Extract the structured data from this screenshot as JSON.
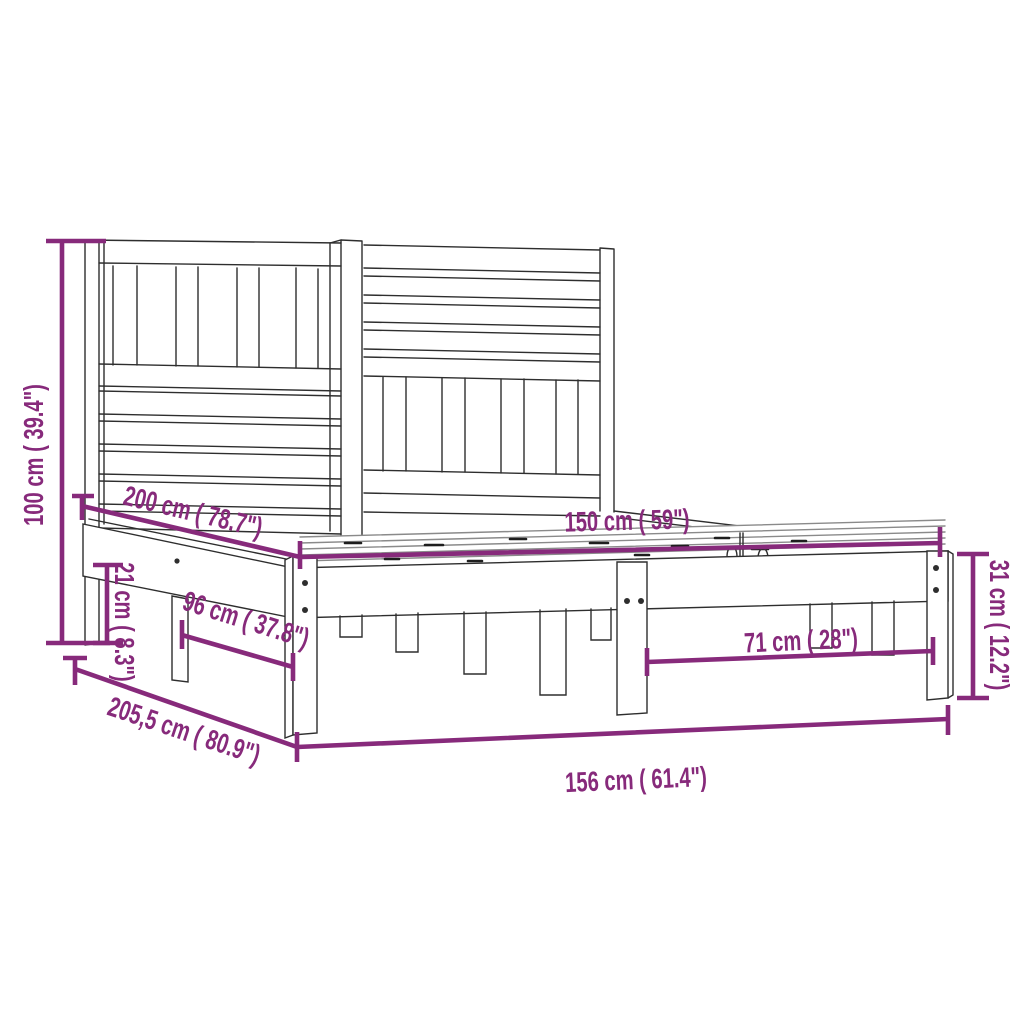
{
  "diagram": {
    "kind": "product-dimension-diagram",
    "subject": "bed-frame-with-slatted-headboard",
    "background_color": "#ffffff",
    "line_color": "#2e2e2e",
    "accent_color": "#872a7b",
    "dimensions": [
      {
        "id": "total-height",
        "value_cm": "100",
        "value_in": "39.4",
        "label": "100 cm ( 39.4\")"
      },
      {
        "id": "inner-length",
        "value_cm": "200",
        "value_in": "78.7",
        "label": "200 cm ( 78.7\")"
      },
      {
        "id": "slat-width",
        "value_cm": "150",
        "value_in": "59",
        "label": "150 cm ( 59\")"
      },
      {
        "id": "rail-clearance",
        "value_cm": "21",
        "value_in": "8.3",
        "label": "21 cm ( 8.3\")"
      },
      {
        "id": "side-leg-span",
        "value_cm": "96",
        "value_in": "37.8",
        "label": "96 cm ( 37.8\")"
      },
      {
        "id": "total-length",
        "value_cm": "205,5",
        "value_in": "80.9",
        "label": "205,5 cm ( 80.9\")"
      },
      {
        "id": "total-width",
        "value_cm": "156",
        "value_in": "61.4",
        "label": "156 cm ( 61.4\")"
      },
      {
        "id": "foot-leg-span",
        "value_cm": "71",
        "value_in": "28",
        "label": "71 cm ( 28\")"
      },
      {
        "id": "foot-end-height",
        "value_cm": "31",
        "value_in": "12.2",
        "label": "31 cm ( 12.2\")"
      }
    ]
  }
}
